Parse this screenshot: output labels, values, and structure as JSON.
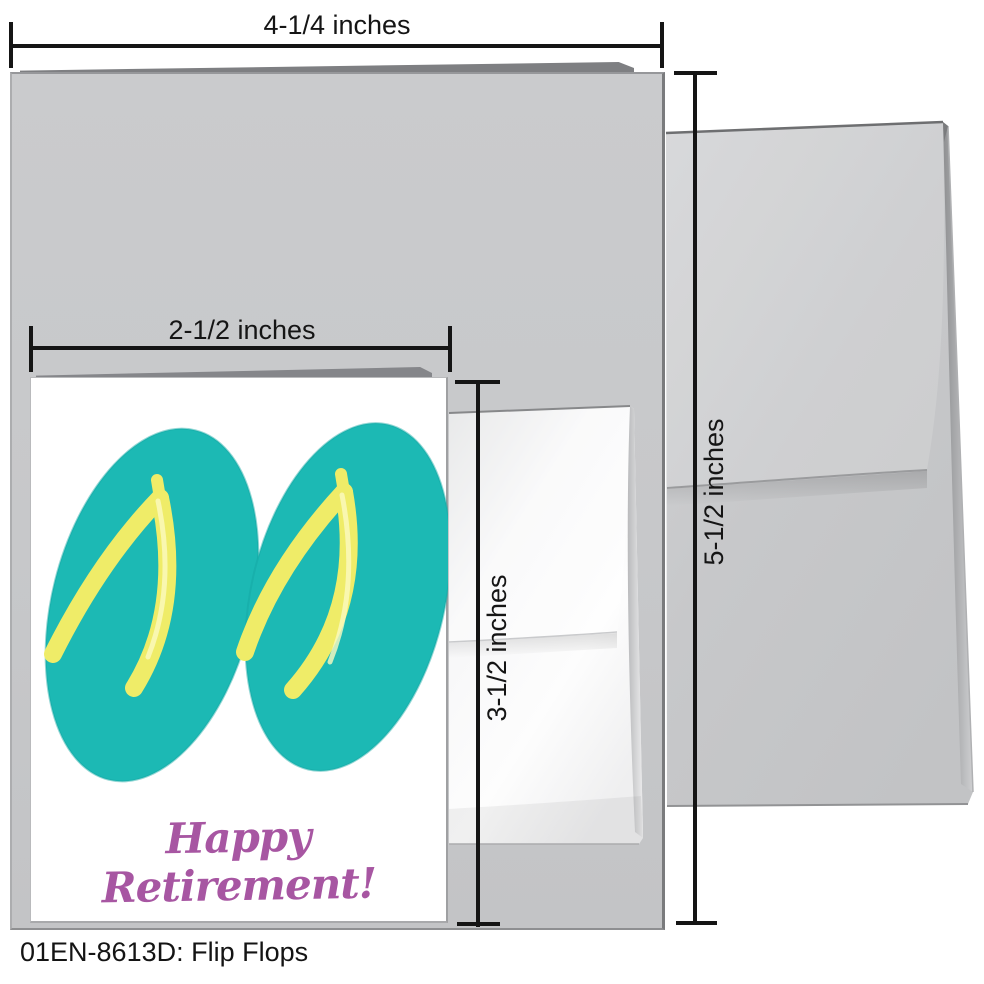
{
  "measurements": {
    "envelope_card_width": "4-1/4 inches",
    "mini_card_width": "2-1/2 inches",
    "mini_card_height": "3-1/2 inches",
    "envelope_card_height": "5-1/2 inches"
  },
  "mini_card": {
    "greeting": "Happy Retirement!"
  },
  "footer": {
    "caption": "01EN-8613D: Flip Flops"
  },
  "colors": {
    "flip_flop_teal": "#1CB9B4",
    "flip_flop_edge": "#14A7A2",
    "strap_yellow": "#EFEC68",
    "strap_highlight": "#FBFAC0",
    "greeting_purple": "#A756A2",
    "card_gray": "#C7C8CA",
    "envelope_gray": "#C9CACC",
    "dimension_line_black": "#151515"
  }
}
